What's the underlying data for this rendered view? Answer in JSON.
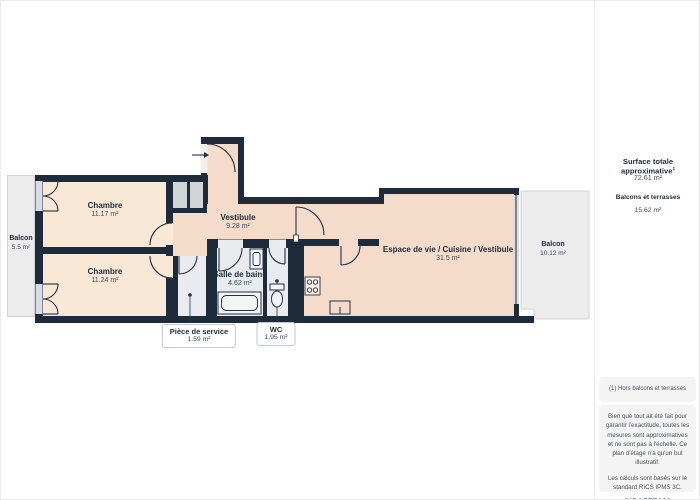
{
  "plan": {
    "rooms": [
      {
        "name": "Balcon",
        "area": "5.5 m²"
      },
      {
        "name": "Chambre",
        "area": "11.17 m²"
      },
      {
        "name": "Chambre",
        "area": "11.24 m²"
      },
      {
        "name": "Vestibule",
        "area": "9.28 m²"
      },
      {
        "name": "Salle de bains",
        "area": "4.62 m²"
      },
      {
        "name": "Espace de vie / Cuisine / Vestibule",
        "area": "31.5 m²"
      },
      {
        "name": "Balcon",
        "area": "10.12 m²"
      }
    ],
    "callouts": [
      {
        "name": "Pièce de service",
        "area": "1.59 m²"
      },
      {
        "name": "WC",
        "area": "1.95 m²"
      }
    ],
    "icons": [
      "entrance-arrow-icon",
      "door-arc-icon",
      "stove-icon",
      "kitchen-sink-icon",
      "bathtub-icon",
      "washbasin-icon",
      "toilet-icon",
      "ceiling-light-dot-icon",
      "window-icon"
    ],
    "colors": {
      "wall": "#1e2b3a",
      "bedroom_fill": "#fae8d7",
      "living_fill": "#f5dcca",
      "service_fill": "#e8ecef",
      "closet_fill": "#d2d5d8",
      "balcony_fill": "#ececec",
      "window_glaze": "#d8dee3"
    }
  },
  "sidebar": {
    "total_label": "Surface totale approximative",
    "total_marker": "1",
    "total_value": "72.61 m²",
    "balconies_label": "Balcons et terrasses",
    "balconies_value": "15.62 m²",
    "footnote": "(1) Hors balcons et terrasses",
    "disclaimer": "Bien que tout ait été fait pour garantir l'exactitude, toutes les mesures sont approximatives et ne sont pas à l'échelle. Ce plan d'étage n'a qu'un but illustratif.",
    "standard": "Les calculs sont basés sur le standard RICS IPMS 3C.",
    "brand": "GIRAFFE",
    "brand_suffix": "360"
  }
}
